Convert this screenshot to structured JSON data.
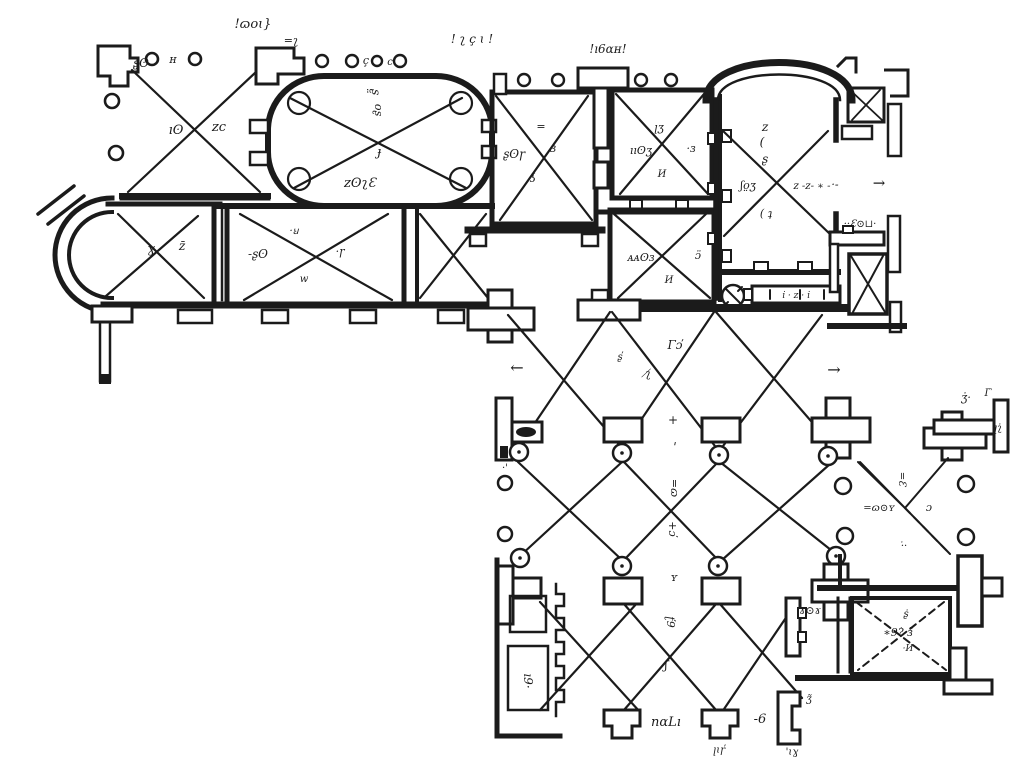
{
  "meta": {
    "description": "Black-and-white scanned architectural floor plan with vaulted bays (X marks), colonnades (circles), an oval hall, apses, and a cloister courtyard with pier lattice",
    "drawing_type": "architectural-floor-plan"
  },
  "colors": {
    "ink": "#1b1b1b",
    "paper": "#ffffff"
  },
  "plan": {
    "annotations": [
      {
        "t": "!ɷoɩ}",
        "x": 253,
        "y": 28,
        "s": 13
      },
      {
        "t": "=ʅ",
        "x": 291,
        "y": 44,
        "s": 11
      },
      {
        "t": "! ʅ ç ɩ !",
        "x": 472,
        "y": 43,
        "s": 12
      },
      {
        "t": "!ı6ɑʜ!",
        "x": 608,
        "y": 53,
        "s": 12
      },
      {
        "t": "ʂʘ",
        "x": 141,
        "y": 67,
        "s": 12
      },
      {
        "t": "ʜ",
        "x": 173,
        "y": 63,
        "s": 11
      },
      {
        "t": "ıʘ",
        "x": 176,
        "y": 134,
        "s": 13
      },
      {
        "t": "ᴢc",
        "x": 219,
        "y": 131,
        "s": 13
      },
      {
        "t": "ç",
        "x": 366,
        "y": 64,
        "s": 11
      },
      {
        "t": "c",
        "x": 390,
        "y": 65,
        "s": 10
      },
      {
        "t": "ʂ̤",
        "x": 372,
        "y": 92,
        "s": 12,
        "r": 90
      },
      {
        "t": "oʂ",
        "x": 375,
        "y": 110,
        "s": 11,
        "r": 90
      },
      {
        "t": "ɟ",
        "x": 379,
        "y": 156,
        "s": 13
      },
      {
        "t": "ᴢʘʅƐ",
        "x": 360,
        "y": 187,
        "s": 13
      },
      {
        "t": "ʂʘɼ",
        "x": 514,
        "y": 158,
        "s": 12
      },
      {
        "t": "ɜ",
        "x": 553,
        "y": 152,
        "s": 12
      },
      {
        "t": "=",
        "x": 541,
        "y": 130,
        "s": 11
      },
      {
        "t": "ʖ",
        "x": 533,
        "y": 182,
        "s": 12
      },
      {
        "t": "ꞁʒ",
        "x": 659,
        "y": 131,
        "s": 11
      },
      {
        "t": "ııʘʒ",
        "x": 641,
        "y": 154,
        "s": 11
      },
      {
        "t": "·ɜ",
        "x": 691,
        "y": 152,
        "s": 11
      },
      {
        "t": "И",
        "x": 662,
        "y": 177,
        "s": 10
      },
      {
        "t": "ᴀᴀʘɜ",
        "x": 641,
        "y": 261,
        "s": 11
      },
      {
        "t": "И",
        "x": 669,
        "y": 283,
        "s": 10
      },
      {
        "t": "ɔ̈",
        "x": 698,
        "y": 259,
        "s": 11
      },
      {
        "t": "ᴢ",
        "x": 765,
        "y": 131,
        "s": 12
      },
      {
        "t": "(",
        "x": 762,
        "y": 146,
        "s": 12
      },
      {
        "t": "ʂ",
        "x": 765,
        "y": 163,
        "s": 12
      },
      {
        "t": "ʃo̤ʒ",
        "x": 748,
        "y": 189,
        "s": 11
      },
      {
        "t": "ᴢ -ᴢ- ∗ -",
        "x": 812,
        "y": 189,
        "s": 10
      },
      {
        "t": "( ʇ",
        "x": 766,
        "y": 217,
        "s": 11
      },
      {
        "t": "··Ɛ⊙⊔·",
        "x": 860,
        "y": 227,
        "s": 10
      },
      {
        "t": "ı̇ · ᴢ · ı̇",
        "x": 796,
        "y": 298,
        "s": 9
      },
      {
        "t": "→",
        "x": 879,
        "y": 188,
        "s": 15
      },
      {
        "t": "·-",
        "x": 835,
        "y": 188,
        "s": 11
      },
      {
        "t": "←",
        "x": 517,
        "y": 373,
        "s": 16
      },
      {
        "t": "→",
        "x": 834,
        "y": 375,
        "s": 16
      },
      {
        "t": "ɣ",
        "x": 151,
        "y": 253,
        "s": 13
      },
      {
        "t": "ᴢ̄",
        "x": 182,
        "y": 250,
        "s": 12
      },
      {
        "t": "-ʂʘ",
        "x": 258,
        "y": 258,
        "s": 12
      },
      {
        "t": "·ꞟ",
        "x": 294,
        "y": 234,
        "s": 10
      },
      {
        "t": "·ɼ",
        "x": 340,
        "y": 255,
        "s": 11
      },
      {
        "t": "w",
        "x": 304,
        "y": 282,
        "s": 10
      },
      {
        "t": "Γɔ̕",
        "x": 675,
        "y": 349,
        "s": 12
      },
      {
        "t": "ʅ̸",
        "x": 648,
        "y": 377,
        "s": 11
      },
      {
        "t": "ʂ̕",
        "x": 620,
        "y": 360,
        "s": 10
      },
      {
        "t": "+",
        "x": 673,
        "y": 424,
        "s": 12
      },
      {
        "t": "ꞌ",
        "x": 675,
        "y": 451,
        "s": 12
      },
      {
        "t": "=ɷ",
        "x": 671,
        "y": 488,
        "s": 11,
        "r": 90
      },
      {
        "t": "+ɔ̕",
        "x": 669,
        "y": 529,
        "s": 11,
        "r": 90
      },
      {
        "t": "ʏ",
        "x": 674,
        "y": 581,
        "s": 11
      },
      {
        "t": "ʈ̕9",
        "x": 667,
        "y": 622,
        "s": 11,
        "r": 90
      },
      {
        "t": "ʃ",
        "x": 666,
        "y": 669,
        "s": 12
      },
      {
        "t": "nɑLı",
        "x": 666,
        "y": 726,
        "s": 13
      },
      {
        "t": "-6",
        "x": 760,
        "y": 723,
        "s": 13
      },
      {
        "t": "ꞁɩɼ̕",
        "x": 719,
        "y": 753,
        "s": 10
      },
      {
        "t": "'ɩɣ",
        "x": 792,
        "y": 755,
        "s": 10
      },
      {
        "t": "ʒ̃",
        "x": 809,
        "y": 702,
        "s": 10
      },
      {
        "t": "ı9·",
        "x": 524,
        "y": 681,
        "s": 12,
        "r": 90
      },
      {
        "t": "·'",
        "x": 505,
        "y": 471,
        "s": 10
      },
      {
        "t": "=ɷ⊙ʏ",
        "x": 879,
        "y": 511,
        "s": 10
      },
      {
        "t": "=Ɛ",
        "x": 899,
        "y": 479,
        "s": 10,
        "r": 90
      },
      {
        "t": "ɔ",
        "x": 929,
        "y": 511,
        "s": 11
      },
      {
        "t": "·̇·",
        "x": 904,
        "y": 549,
        "s": 10
      },
      {
        "t": "ʒ̇·",
        "x": 966,
        "y": 401,
        "s": 11
      },
      {
        "t": "ꞁʅ̇",
        "x": 998,
        "y": 431,
        "s": 10
      },
      {
        "t": "Γ̇",
        "x": 988,
        "y": 396,
        "s": 10
      },
      {
        "t": "ɤ⊙ɤ",
        "x": 810,
        "y": 614,
        "s": 11
      },
      {
        "t": "ʂ̇",
        "x": 906,
        "y": 617,
        "s": 10
      },
      {
        "t": "∗9?̇ ɜ̃",
        "x": 898,
        "y": 636,
        "s": 11
      },
      {
        "t": "·И",
        "x": 908,
        "y": 651,
        "s": 9
      }
    ]
  }
}
